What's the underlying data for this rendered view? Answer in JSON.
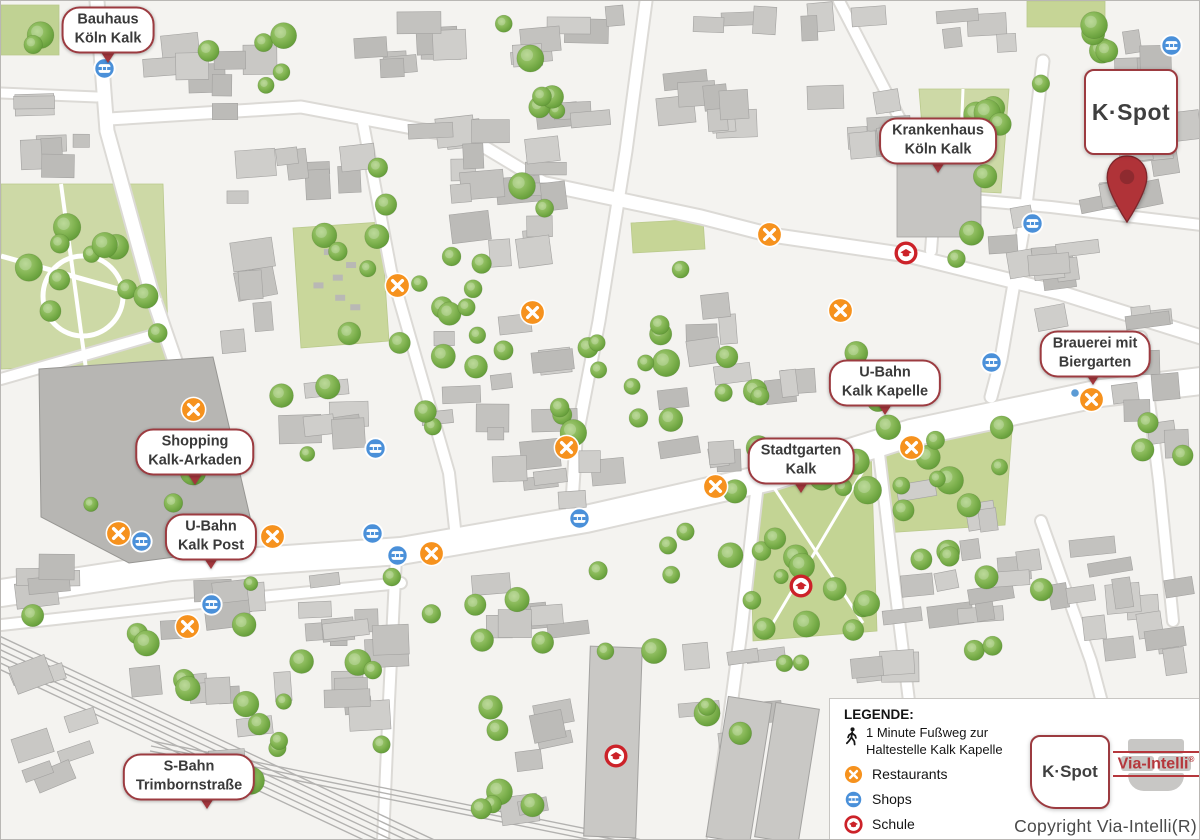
{
  "brand": {
    "kspot": "K·Spot",
    "via_intelli": "Via-Intelli",
    "registered_mark": "®",
    "copyright": "Copyright Via-Intelli(R)"
  },
  "map_labels": [
    {
      "id": "bauhaus",
      "line1": "Bauhaus",
      "line2": "Köln Kalk",
      "x": 107,
      "y": 29,
      "tip_x": 107,
      "tip_y": 62
    },
    {
      "id": "krankenhaus",
      "line1": "Krankenhaus",
      "line2": "Köln Kalk",
      "x": 937,
      "y": 140,
      "tip_x": 937,
      "tip_y": 172
    },
    {
      "id": "brauerei",
      "line1": "Brauerei mit",
      "line2": "Biergarten",
      "x": 1094,
      "y": 353,
      "tip_x": 1092,
      "tip_y": 384
    },
    {
      "id": "ubahn-kalk-kapelle",
      "line1": "U-Bahn",
      "line2": "Kalk Kapelle",
      "x": 884,
      "y": 382,
      "tip_x": 884,
      "tip_y": 414
    },
    {
      "id": "stadtgarten-kalk",
      "line1": "Stadtgarten",
      "line2": "Kalk",
      "x": 800,
      "y": 460,
      "tip_x": 800,
      "tip_y": 492
    },
    {
      "id": "shopping-kalk-arkaden",
      "line1": "Shopping",
      "line2": "Kalk-Arkaden",
      "x": 194,
      "y": 451,
      "tip_x": 194,
      "tip_y": 484
    },
    {
      "id": "ubahn-kalk-post",
      "line1": "U-Bahn",
      "line2": "Kalk Post",
      "x": 210,
      "y": 536,
      "tip_x": 210,
      "tip_y": 568
    },
    {
      "id": "sbahn-trimbornstrasse",
      "line1": "S-Bahn",
      "line2": "Trimbornstraße",
      "x": 188,
      "y": 776,
      "tip_x": 206,
      "tip_y": 808
    }
  ],
  "markers": {
    "restaurants": [
      {
        "x": 768,
        "y": 233
      },
      {
        "x": 839,
        "y": 309
      },
      {
        "x": 396,
        "y": 284
      },
      {
        "x": 531,
        "y": 311
      },
      {
        "x": 565,
        "y": 446
      },
      {
        "x": 192,
        "y": 408
      },
      {
        "x": 910,
        "y": 446
      },
      {
        "x": 1090,
        "y": 398
      },
      {
        "x": 714,
        "y": 485
      },
      {
        "x": 271,
        "y": 535
      },
      {
        "x": 430,
        "y": 552
      },
      {
        "x": 117,
        "y": 532
      },
      {
        "x": 186,
        "y": 625
      }
    ],
    "shops": [
      {
        "x": 103,
        "y": 67
      },
      {
        "x": 1170,
        "y": 44
      },
      {
        "x": 1031,
        "y": 222
      },
      {
        "x": 990,
        "y": 361
      },
      {
        "x": 374,
        "y": 447
      },
      {
        "x": 371,
        "y": 532
      },
      {
        "x": 396,
        "y": 554
      },
      {
        "x": 578,
        "y": 517
      },
      {
        "x": 140,
        "y": 540
      },
      {
        "x": 210,
        "y": 603
      }
    ],
    "schools": [
      {
        "x": 905,
        "y": 252
      },
      {
        "x": 800,
        "y": 585
      },
      {
        "x": 615,
        "y": 755
      }
    ]
  },
  "kspot_pin": {
    "x": 1126,
    "y": 222
  },
  "legend": {
    "title": "LEGENDE:",
    "walk_line1": "1 Minute Fußweg zur",
    "walk_line2": "Haltestelle Kalk Kapelle",
    "items": [
      {
        "id": "restaurants",
        "label": "Restaurants"
      },
      {
        "id": "shops",
        "label": "Shops"
      },
      {
        "id": "schule",
        "label": "Schule"
      }
    ]
  },
  "colors": {
    "restaurant": "#f6921e",
    "shop": "#4a90d9",
    "school": "#cc2229",
    "pin": "#b03338",
    "label_border": "#9c3b40",
    "park": "#ccd8a2",
    "building": "#c7c6c3",
    "via_intelli_red": "#b5373c"
  }
}
